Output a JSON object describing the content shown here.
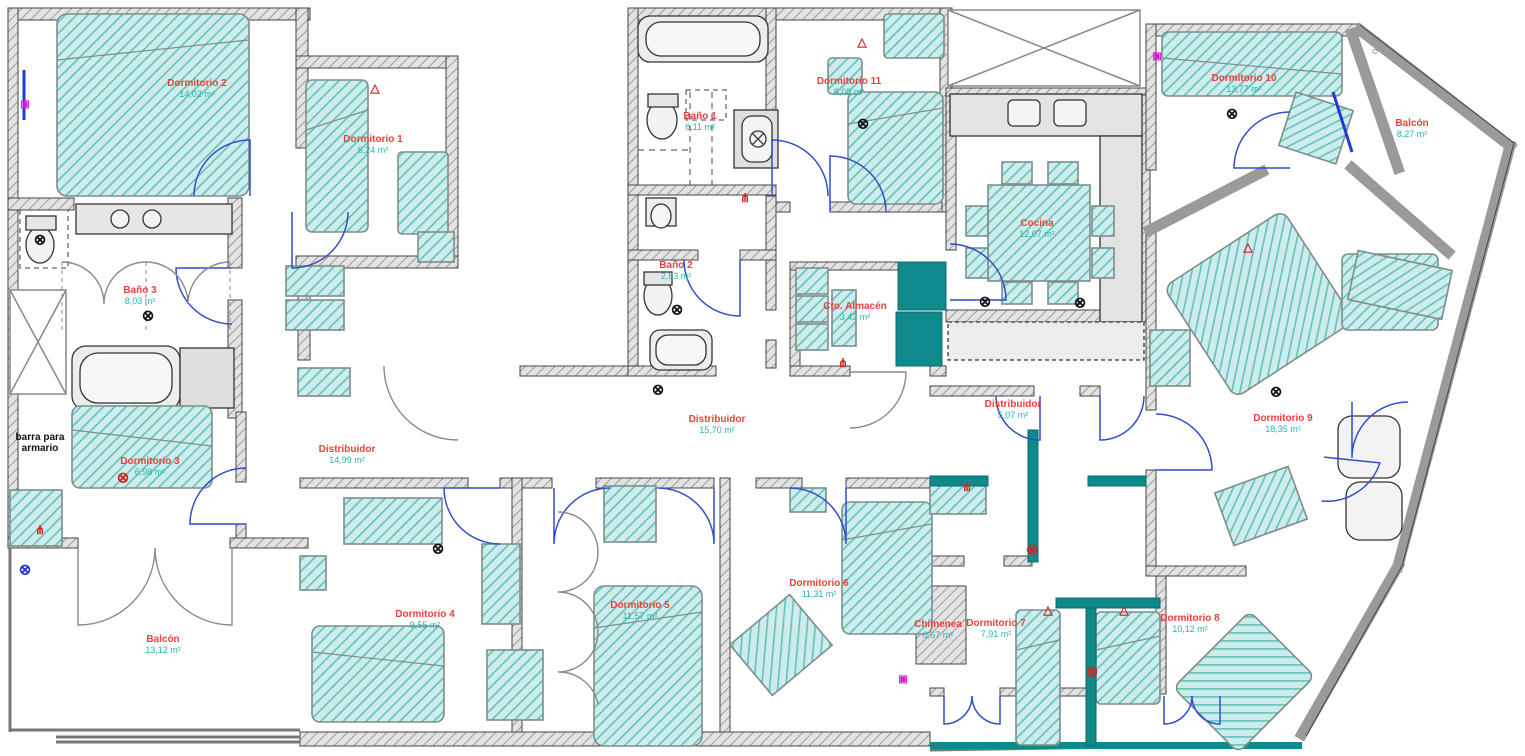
{
  "plan": {
    "title": "Plano de planta - vivienda",
    "colors": {
      "room_name": "#e8413c",
      "room_area": "#2ab3ac",
      "note_text": "#111111",
      "wall": "#8f8f8f",
      "wall_edge": "#444444",
      "furniture_fill": "#9fd9d5",
      "furniture_line": "#49b0a9",
      "cabinet_solid": "#0e8a8c",
      "door_arc_blue": "#2f4fc9",
      "door_arc_gray": "#8a8a8a",
      "fixture_fill": "#e6e6e6"
    },
    "rooms": [
      {
        "name": "Dormitorio 2",
        "area": "14,02 m²",
        "x": 197,
        "y": 89
      },
      {
        "name": "Dormitorio 1",
        "area": "6,24 m²",
        "x": 373,
        "y": 145
      },
      {
        "name": "Baño 3",
        "area": "8,03 m²",
        "x": 140,
        "y": 296
      },
      {
        "name": "Dormitorio 3",
        "area": "6,98 m²",
        "x": 150,
        "y": 467
      },
      {
        "name": "Distribuidor",
        "area": "14,99 m²",
        "x": 347,
        "y": 455
      },
      {
        "name": "Balcón",
        "area": "13,12 m²",
        "x": 163,
        "y": 645
      },
      {
        "name": "Dormitorio 4",
        "area": "9,55 m²",
        "x": 425,
        "y": 620
      },
      {
        "name": "Baño 1",
        "area": "6,11 m²",
        "x": 700,
        "y": 122
      },
      {
        "name": "Dormitorio 11",
        "area": "8,08 m²",
        "x": 849,
        "y": 87
      },
      {
        "name": "Baño 2",
        "area": "2,83 m²",
        "x": 676,
        "y": 271
      },
      {
        "name": "Cto. Almacén",
        "area": "3,42 m²",
        "x": 855,
        "y": 312
      },
      {
        "name": "Cocina",
        "area": "12,07 m²",
        "x": 1037,
        "y": 229
      },
      {
        "name": "Distribuidor",
        "area": "15,70 m²",
        "x": 717,
        "y": 425
      },
      {
        "name": "Distribuidor",
        "area": "5,07 m²",
        "x": 1013,
        "y": 410
      },
      {
        "name": "Dormitorio 5",
        "area": "11,57 m²",
        "x": 640,
        "y": 611
      },
      {
        "name": "Dormitorio 6",
        "area": "11,31 m²",
        "x": 819,
        "y": 589
      },
      {
        "name": "Chimenea",
        "area": "0,67 m²",
        "x": 938,
        "y": 630
      },
      {
        "name": "Dormitorio 7",
        "area": "7,91 m²",
        "x": 996,
        "y": 629
      },
      {
        "name": "Dormitorio 8",
        "area": "10,12 m²",
        "x": 1190,
        "y": 624
      },
      {
        "name": "Dormitorio 9",
        "area": "18,35 m²",
        "x": 1283,
        "y": 424
      },
      {
        "name": "Dormitorio 10",
        "area": "13,77 m²",
        "x": 1244,
        "y": 84
      },
      {
        "name": "Balcón",
        "area": "8,27 m²",
        "x": 1412,
        "y": 129
      }
    ],
    "notes": [
      {
        "text": "barra para\narmario",
        "x": 40,
        "y": 443
      }
    ],
    "symbols": [
      {
        "type": "ceiling-light",
        "color": "#111111",
        "x": 40,
        "y": 240
      },
      {
        "type": "ceiling-light",
        "color": "#111111",
        "x": 148,
        "y": 316
      },
      {
        "type": "ceiling-light",
        "color": "#d22222",
        "x": 123,
        "y": 478
      },
      {
        "type": "ceiling-light",
        "color": "#111111",
        "x": 438,
        "y": 549
      },
      {
        "type": "ceiling-light",
        "color": "#111111",
        "x": 658,
        "y": 390
      },
      {
        "type": "ceiling-light",
        "color": "#111111",
        "x": 677,
        "y": 310
      },
      {
        "type": "ceiling-light",
        "color": "#111111",
        "x": 863,
        "y": 124
      },
      {
        "type": "ceiling-light",
        "color": "#111111",
        "x": 985,
        "y": 302
      },
      {
        "type": "ceiling-light",
        "color": "#111111",
        "x": 1080,
        "y": 303
      },
      {
        "type": "ceiling-light",
        "color": "#111111",
        "x": 1232,
        "y": 114
      },
      {
        "type": "ceiling-light",
        "color": "#111111",
        "x": 1276,
        "y": 392
      },
      {
        "type": "ceiling-light",
        "color": "#d22222",
        "x": 1032,
        "y": 550
      },
      {
        "type": "ceiling-light",
        "color": "#d22222",
        "x": 1092,
        "y": 672
      },
      {
        "type": "ceiling-light",
        "color": "#2233cc",
        "x": 25,
        "y": 570
      },
      {
        "type": "wall-lamp-triangle",
        "color": "#d22222",
        "x": 375,
        "y": 88
      },
      {
        "type": "wall-lamp-triangle",
        "color": "#d22222",
        "x": 862,
        "y": 42
      },
      {
        "type": "wall-lamp-triangle",
        "color": "#d22222",
        "x": 1048,
        "y": 610
      },
      {
        "type": "wall-lamp-triangle",
        "color": "#d22222",
        "x": 1124,
        "y": 610
      },
      {
        "type": "wall-lamp-triangle",
        "color": "#d22222",
        "x": 1248,
        "y": 247
      },
      {
        "type": "outlet",
        "color": "#d22222",
        "x": 40,
        "y": 530
      },
      {
        "type": "outlet",
        "color": "#d22222",
        "x": 745,
        "y": 198
      },
      {
        "type": "outlet",
        "color": "#d22222",
        "x": 843,
        "y": 363
      },
      {
        "type": "outlet",
        "color": "#d22222",
        "x": 967,
        "y": 487
      },
      {
        "type": "socket-box",
        "color": "#cc22cc",
        "x": 25,
        "y": 105
      },
      {
        "type": "socket-box",
        "color": "#cc22cc",
        "x": 903,
        "y": 680
      },
      {
        "type": "socket-box",
        "color": "#cc22cc",
        "x": 1157,
        "y": 57
      },
      {
        "type": "window-mark",
        "color": "#2233cc",
        "x": 1375,
        "y": 52
      }
    ]
  }
}
